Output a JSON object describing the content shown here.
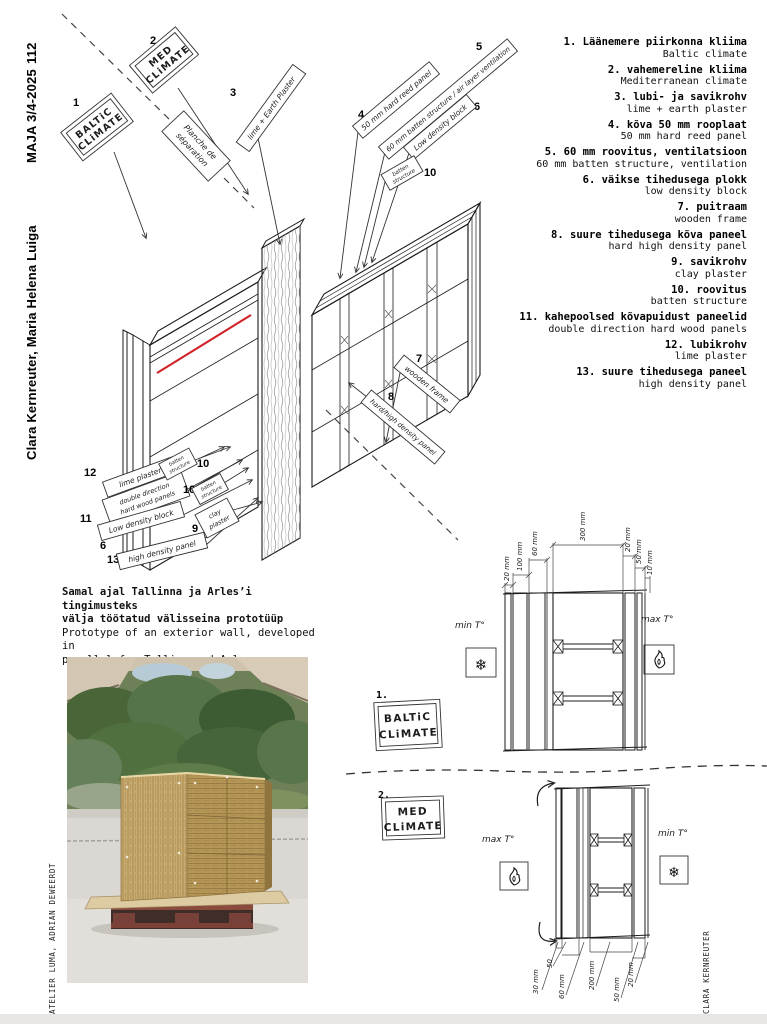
{
  "magazine": {
    "page_number": "112",
    "issue": "MAJA 3/4-2025",
    "authors": "Clara Kernreuter, Maria Helena Luiga",
    "photo_credit": "ATELIER LUMA, ADRIAN DEWEERDT",
    "drawing_credit": "CLARA KERNREUTER"
  },
  "legend": {
    "items": [
      {
        "et": "1. Läänemere piirkonna kliima",
        "en": "Baltic climate"
      },
      {
        "et": "2. vahemereline kliima",
        "en": "Mediterranean climate"
      },
      {
        "et": "3. lubi- ja savikrohv",
        "en": "lime + earth plaster"
      },
      {
        "et": "4. kõva 50 mm rooplaat",
        "en": "50 mm hard reed panel"
      },
      {
        "et": "5. 60 mm roovitus, ventilatsioon",
        "en": "60 mm batten structure, ventilation"
      },
      {
        "et": "6. väikse tihedusega plokk",
        "en": "low density block"
      },
      {
        "et": "7. puitraam",
        "en": "wooden frame"
      },
      {
        "et": "8. suure tihedusega kõva paneel",
        "en": "hard high density panel"
      },
      {
        "et": "9. savikrohv",
        "en": "clay plaster"
      },
      {
        "et": "10. roovitus",
        "en": "batten structure"
      },
      {
        "et": "11. kahepoolsed kõvapuidust paneelid",
        "en": "double direction hard wood panels"
      },
      {
        "et": "12. lubikrohv",
        "en": "lime plaster"
      },
      {
        "et": "13. suure tihedusega paneel",
        "en": "high density panel"
      }
    ]
  },
  "caption": {
    "et_1": "Samal ajal Tallinna ja Arles’i tingimusteks",
    "et_2": "välja töötatud välisseina prototüüp",
    "en_1": "Prototype of an exterior wall, developed in",
    "en_2": "parallel for Tallinn and Arles"
  },
  "diagram": {
    "n1": "1",
    "climate1_l1": "BALTiC",
    "climate1_l2": "CLiMATE",
    "n2": "2",
    "climate2_l1": "MED",
    "climate2_l2": "CLiMATE",
    "separator_l1": "Planche de",
    "separator_l2": "séparation",
    "n3": "3",
    "label3": "lime + Earth Plaster",
    "n4": "4",
    "label4": "50 mm hard reed panel",
    "n5": "5",
    "label5": "60 mm batten structure / air layer ventilation",
    "n6": "6",
    "label6": "Low density block",
    "n7": "7",
    "label7": "wooden frame",
    "n8": "8",
    "label8": "hard/high density panel",
    "n9": "9",
    "label9_l1": "clay",
    "label9_l2": "plaster",
    "n10": "10",
    "label10_l1": "batten",
    "label10_l2": "structure",
    "n11": "11",
    "label11_l1": "double direction",
    "label11_l2": "hard wood panels",
    "n12": "12",
    "label12": "lime plaster",
    "n13": "13",
    "label13": "high density panel",
    "label6b": "Low density block",
    "accent_color": "#d2232a"
  },
  "sections": {
    "baltic": {
      "num": "1.",
      "title_l1": "BALTiC",
      "title_l2": "CLiMATE",
      "cold_label": "min T°",
      "hot_label": "max T°",
      "measurements": [
        "20 mm",
        "100 mm",
        "60 mm",
        "300 mm",
        "20 mm",
        "50 mm",
        "10 mm"
      ]
    },
    "med": {
      "num": "2.",
      "title_l1": "MED",
      "title_l2": "CLiMATE",
      "hot_label": "max T°",
      "cold_label": "min T°",
      "measurements": [
        "30 mm",
        "50",
        "60 mm",
        "200 mm",
        "50 mm",
        "20 mm"
      ]
    }
  }
}
